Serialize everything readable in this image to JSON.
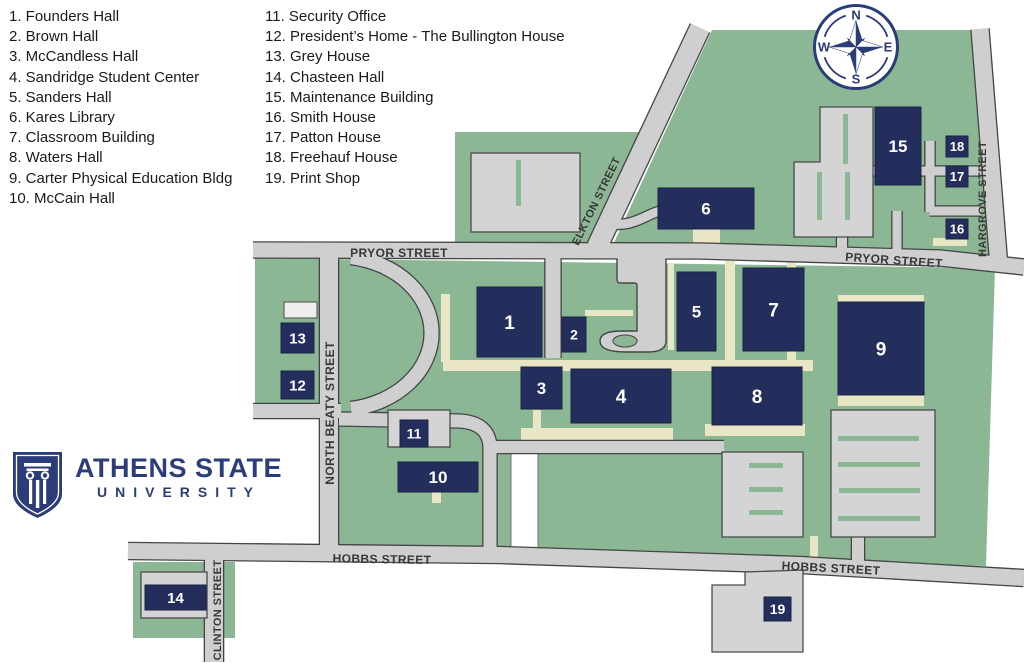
{
  "legend": {
    "column1": [
      "1. Founders Hall",
      "2. Brown Hall",
      "3. McCandless Hall",
      "4. Sandridge Student Center",
      "5. Sanders Hall",
      "6. Kares Library",
      "7. Classroom Building",
      "8. Waters Hall",
      "9. Carter Physical Education Bldg",
      "10. McCain Hall"
    ],
    "column2": [
      "11. Security Office",
      "12. President’s Home - The Bullington House",
      "13. Grey House",
      "14. Chasteen Hall",
      "15. Maintenance Building",
      "16. Smith House",
      "17. Patton House",
      "18. Freehauf House",
      "19. Print Shop"
    ]
  },
  "logo": {
    "title": "ATHENS STATE",
    "subtitle": "UNIVERSITY"
  },
  "compass": {
    "points": [
      "N",
      "E",
      "S",
      "W"
    ]
  },
  "colors": {
    "green": "#8cb795",
    "building": "#232e5c",
    "building_edge": "#1a2244",
    "navy": "#2c3c78",
    "tan": "#e9e6c6",
    "road": "#cfcfcf",
    "road_edge": "#454545",
    "lot": "#d4d4d4",
    "lot_edge": "#4a4a4a",
    "street_label": "#383838",
    "footprint": "#ededed",
    "number": "#ffffff"
  },
  "map": {
    "green_areas": [
      {
        "name": "green-northwest-block",
        "points": [
          [
            455,
            132
          ],
          [
            646,
            132
          ],
          [
            592,
            247
          ],
          [
            455,
            247
          ]
        ]
      },
      {
        "name": "green-northeast-block",
        "points": [
          [
            712,
            30
          ],
          [
            973,
            30
          ],
          [
            990,
            250
          ],
          [
            990,
            262
          ],
          [
            612,
            247
          ]
        ]
      },
      {
        "name": "green-main-campus-block",
        "points": [
          [
            255,
            258
          ],
          [
            995,
            268
          ],
          [
            986,
            566
          ],
          [
            339,
            551
          ],
          [
            339,
            418
          ],
          [
            255,
            418
          ]
        ]
      },
      {
        "name": "green-chasteen-block",
        "points": [
          [
            133,
            562
          ],
          [
            235,
            562
          ],
          [
            235,
            638
          ],
          [
            133,
            638
          ]
        ]
      }
    ],
    "white_gaps": [
      {
        "x": 511,
        "y": 452,
        "w": 27,
        "h": 103
      }
    ],
    "walkways": [
      [
        443,
        360,
        370,
        11
      ],
      [
        441,
        294,
        9,
        68
      ],
      [
        521,
        428,
        152,
        12
      ],
      [
        705,
        424,
        100,
        12
      ],
      [
        838,
        295,
        86,
        8
      ],
      [
        838,
        395,
        86,
        11
      ],
      [
        725,
        260,
        10,
        100
      ],
      [
        787,
        262,
        9,
        98
      ],
      [
        693,
        228,
        27,
        15
      ],
      [
        933,
        238,
        34,
        8
      ],
      [
        810,
        536,
        8,
        24
      ],
      [
        432,
        491,
        9,
        12
      ],
      [
        585,
        310,
        48,
        6
      ],
      [
        668,
        264,
        6,
        86
      ],
      [
        533,
        410,
        8,
        20
      ]
    ],
    "road_areas": [
      {
        "name": "brown-hall-drive-plaza",
        "d": "M 617,250 L 666,250 L 666,341 Q 666,352 648,352 L 626,352 Q 600,352 600,341 Q 600,331 622,331 L 637,331 L 637,285 Q 637,283 634,283 L 620,283 Q 617,283 617,279 Z"
      }
    ],
    "islands": [
      {
        "cx": 625,
        "cy": 341,
        "rx": 12,
        "ry": 6
      }
    ],
    "roads": [
      {
        "name": "pryor-street-road",
        "points": [
          [
            253,
            250
          ],
          [
            700,
            251
          ],
          [
            940,
            258
          ],
          [
            1024,
            267
          ]
        ],
        "w": 15
      },
      {
        "name": "north-beaty-street-road",
        "points": [
          [
            329,
            244
          ],
          [
            329,
            560
          ]
        ],
        "w": 18
      },
      {
        "name": "elkton-street-road",
        "points": [
          [
            700,
            28
          ],
          [
            597,
            247
          ]
        ],
        "w": 20
      },
      {
        "name": "hargrove-street-road",
        "points": [
          [
            980,
            29
          ],
          [
            999,
            267
          ]
        ],
        "w": 17
      },
      {
        "name": "hobbs-street-road",
        "points": [
          [
            128,
            551
          ],
          [
            500,
            555
          ],
          [
            800,
            565
          ],
          [
            1024,
            578
          ]
        ],
        "w": 16
      },
      {
        "name": "clinton-street-road",
        "points": [
          [
            214,
            558
          ],
          [
            214,
            662
          ]
        ],
        "w": 18
      },
      {
        "name": "west-drive",
        "points": [
          [
            253,
            411
          ],
          [
            341,
            411
          ]
        ],
        "w": 14
      },
      {
        "name": "loop-drive",
        "d": "M 351,257 A 96,77 0 0 1 351,409",
        "w": 14
      },
      {
        "name": "south-campus-drive",
        "d": "M 339,419 L 460,421 Q 489,423 490,447 L 490,553",
        "w": 13
      },
      {
        "name": "lawn-north-drive",
        "points": [
          [
            490,
            447
          ],
          [
            724,
            447
          ]
        ],
        "w": 12
      },
      {
        "name": "library-drive",
        "d": "M 606,223 C 632,229 646,214 660,211",
        "w": 9
      },
      {
        "name": "maintenance-drive-1",
        "points": [
          [
            873,
            171
          ],
          [
            981,
            171
          ]
        ],
        "w": 9
      },
      {
        "name": "maintenance-drive-2",
        "points": [
          [
            930,
            141
          ],
          [
            930,
            212
          ]
        ],
        "w": 9
      },
      {
        "name": "maintenance-drive-3",
        "points": [
          [
            930,
            211
          ],
          [
            981,
            211
          ]
        ],
        "w": 9
      },
      {
        "name": "maintenance-drive-4",
        "points": [
          [
            897,
            211
          ],
          [
            897,
            251
          ]
        ],
        "w": 9
      },
      {
        "name": "lot-connector-north",
        "points": [
          [
            842,
            236
          ],
          [
            842,
            252
          ]
        ],
        "w": 10
      },
      {
        "name": "lot-connector-south",
        "points": [
          [
            858,
            537
          ],
          [
            858,
            566
          ]
        ],
        "w": 12
      },
      {
        "name": "founders-drive",
        "points": [
          [
            553,
            251
          ],
          [
            553,
            358
          ]
        ],
        "w": 15
      }
    ],
    "lots": [
      {
        "name": "northwest-parking-lot",
        "rect": [
          471,
          153,
          109,
          79
        ]
      },
      {
        "name": "maintenance-parking-lot",
        "points": [
          [
            820,
            107
          ],
          [
            873,
            107
          ],
          [
            873,
            237
          ],
          [
            794,
            237
          ],
          [
            794,
            162
          ],
          [
            820,
            162
          ]
        ]
      },
      {
        "name": "southeast-parking-lot-west",
        "rect": [
          722,
          452,
          81,
          85
        ]
      },
      {
        "name": "southeast-parking-lot-east",
        "rect": [
          831,
          410,
          104,
          127
        ]
      },
      {
        "name": "chasteen-lot",
        "rect": [
          141,
          572,
          66,
          46
        ]
      },
      {
        "name": "print-shop-lot",
        "points": [
          [
            712,
            585
          ],
          [
            745,
            585
          ],
          [
            745,
            572
          ],
          [
            803,
            570
          ],
          [
            803,
            652
          ],
          [
            712,
            652
          ]
        ]
      },
      {
        "name": "security-office-lot",
        "rect": [
          388,
          410,
          62,
          37
        ]
      }
    ],
    "lot_stripes": [
      [
        843,
        114,
        5,
        50
      ],
      [
        817,
        172,
        5,
        48
      ],
      [
        845,
        172,
        5,
        48
      ],
      [
        516,
        160,
        5,
        46
      ],
      [
        749,
        463,
        34,
        5
      ],
      [
        749,
        487,
        34,
        5
      ],
      [
        749,
        510,
        34,
        5
      ],
      [
        838,
        436,
        81,
        5
      ],
      [
        838,
        462,
        82,
        5
      ],
      [
        839,
        488,
        81,
        5
      ],
      [
        838,
        516,
        82,
        5
      ]
    ],
    "footprints": [
      {
        "x": 284,
        "y": 302,
        "w": 33,
        "h": 16
      }
    ],
    "buildings": [
      {
        "label": "1",
        "x": 477,
        "y": 287,
        "w": 65,
        "h": 70,
        "fs": 19
      },
      {
        "label": "2",
        "x": 562,
        "y": 317,
        "w": 24,
        "h": 35,
        "fs": 14
      },
      {
        "label": "3",
        "x": 521,
        "y": 367,
        "w": 41,
        "h": 42,
        "fs": 17
      },
      {
        "label": "4",
        "x": 571,
        "y": 369,
        "w": 100,
        "h": 54,
        "fs": 19
      },
      {
        "label": "5",
        "x": 677,
        "y": 272,
        "w": 39,
        "h": 79,
        "fs": 17
      },
      {
        "label": "6",
        "x": 658,
        "y": 188,
        "w": 96,
        "h": 41,
        "fs": 17
      },
      {
        "label": "7",
        "x": 743,
        "y": 268,
        "w": 61,
        "h": 83,
        "fs": 19
      },
      {
        "label": "8",
        "x": 712,
        "y": 367,
        "w": 90,
        "h": 58,
        "fs": 19
      },
      {
        "label": "9",
        "x": 838,
        "y": 302,
        "w": 86,
        "h": 93,
        "fs": 19
      },
      {
        "label": "10",
        "x": 398,
        "y": 462,
        "w": 80,
        "h": 30,
        "fs": 17
      },
      {
        "label": "11",
        "x": 400,
        "y": 420,
        "w": 28,
        "h": 27,
        "fs": 14
      },
      {
        "label": "12",
        "x": 281,
        "y": 371,
        "w": 33,
        "h": 28,
        "fs": 15
      },
      {
        "label": "13",
        "x": 281,
        "y": 323,
        "w": 33,
        "h": 30,
        "fs": 15
      },
      {
        "label": "14",
        "x": 145,
        "y": 585,
        "w": 61,
        "h": 25,
        "fs": 15
      },
      {
        "label": "15",
        "x": 875,
        "y": 107,
        "w": 46,
        "h": 78,
        "fs": 17
      },
      {
        "label": "16",
        "x": 946,
        "y": 219,
        "w": 22,
        "h": 20,
        "fs": 13
      },
      {
        "label": "17",
        "x": 946,
        "y": 166,
        "w": 22,
        "h": 21,
        "fs": 13
      },
      {
        "label": "18",
        "x": 946,
        "y": 136,
        "w": 22,
        "h": 21,
        "fs": 13
      },
      {
        "label": "19",
        "x": 764,
        "y": 597,
        "w": 27,
        "h": 24,
        "fs": 14
      }
    ],
    "street_labels": [
      {
        "name": "pryor-street-label-west",
        "text": "PRYOR STREET",
        "x": 399,
        "y": 253,
        "rot": 0,
        "fs": 12
      },
      {
        "name": "pryor-street-label-east",
        "text": "PRYOR STREET",
        "x": 894,
        "y": 260,
        "rot": 4,
        "fs": 12
      },
      {
        "name": "elkton-street-label",
        "text": "ELKTON STREET",
        "x": 596,
        "y": 201,
        "rot": -64,
        "fs": 11
      },
      {
        "name": "north-beaty-street-label",
        "text": "NORTH BEATY STREET",
        "x": 330,
        "y": 413,
        "rot": -90,
        "fs": 12
      },
      {
        "name": "hargrove-street-label",
        "text": "HARGROVE STREET",
        "x": 982,
        "y": 199,
        "rot": -90,
        "fs": 11
      },
      {
        "name": "hobbs-street-label-west",
        "text": "HOBBS STREET",
        "x": 382,
        "y": 559,
        "rot": 1,
        "fs": 12
      },
      {
        "name": "hobbs-street-label-east",
        "text": "HOBBS STREET",
        "x": 831,
        "y": 568,
        "rot": 3,
        "fs": 12
      },
      {
        "name": "clinton-street-label",
        "text": "CLINTON STREET",
        "x": 217,
        "y": 610,
        "rot": -90,
        "fs": 11
      }
    ]
  }
}
